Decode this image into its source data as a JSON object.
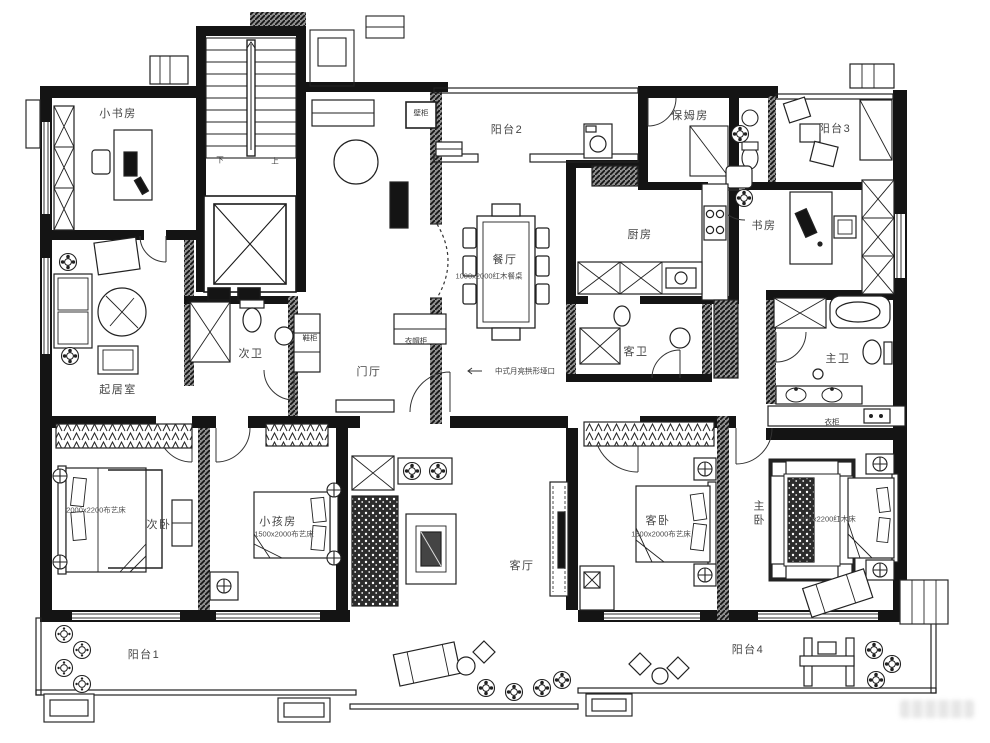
{
  "rooms": {
    "small_study": "小书房",
    "balcony2": "阳台2",
    "maid_room": "保姆房",
    "balcony3": "阳台3",
    "study": "书房",
    "kitchen": "厨房",
    "dining": "餐厅",
    "family_room": "起居室",
    "second_bath": "次卫",
    "foyer": "门厅",
    "guest_bath": "客卫",
    "master_bath": "主卫",
    "second_bedroom": "次卧",
    "kids_room": "小孩房",
    "living_room": "客厅",
    "guest_bedroom": "客卧",
    "master_bedroom": "主卧",
    "balcony1": "阳台1",
    "balcony4": "阳台4"
  },
  "annotations": {
    "wall_cabinet": "壁柜",
    "shoe_cabinet": "鞋柜",
    "coat_cabinet": "衣帽柜",
    "wardrobe": "衣柜",
    "stairs_down": "下",
    "stairs_up": "上",
    "moon_arch": "中式月亮拱形垭口"
  },
  "dimensions": {
    "dining_table": "1000x2000红木餐桌",
    "second_bed": "2000x2200布艺床",
    "kids_bed": "1500x2000布艺床",
    "guest_bed": "1500x2000布艺床",
    "master_bed": "1800x2200红木床"
  }
}
